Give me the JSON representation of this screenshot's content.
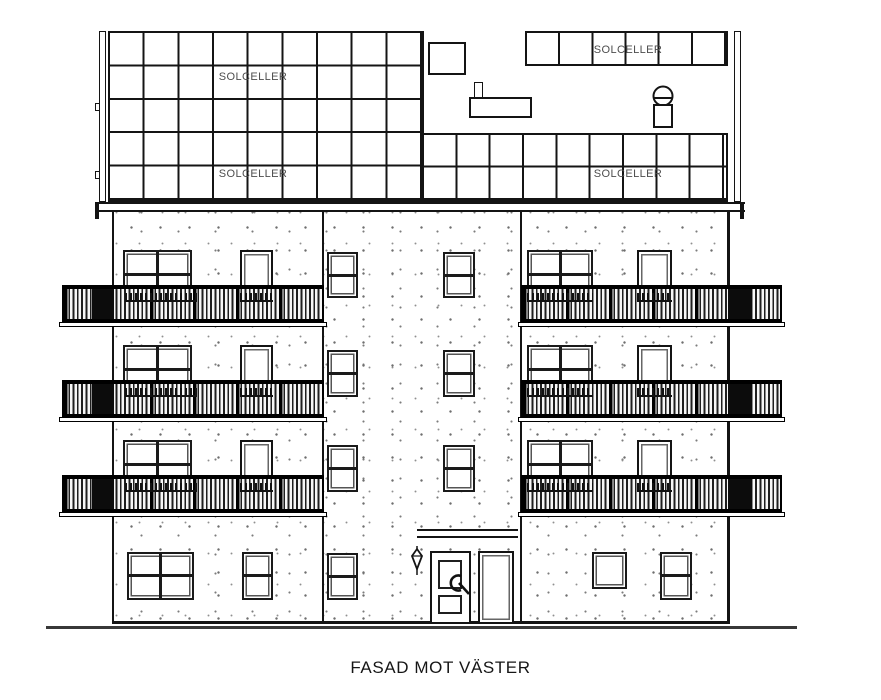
{
  "labels": {
    "title": "FASAD MOT VÄSTER",
    "solar_labels": [
      {
        "position": "roof-upper-left",
        "text": "SOLCELLER"
      },
      {
        "position": "roof-upper-right",
        "text": "SOLCELLER"
      },
      {
        "position": "roof-lower-left",
        "text": "SOLCELLER"
      },
      {
        "position": "roof-lower-right",
        "text": "SOLCELLER"
      }
    ]
  },
  "colors": {
    "line": "#141414",
    "solar_label_text": "#4d4d4d",
    "stipple_dot": "#7d7d7d",
    "railing_dark": "#0c0c0c",
    "background": "#ffffff"
  }
}
